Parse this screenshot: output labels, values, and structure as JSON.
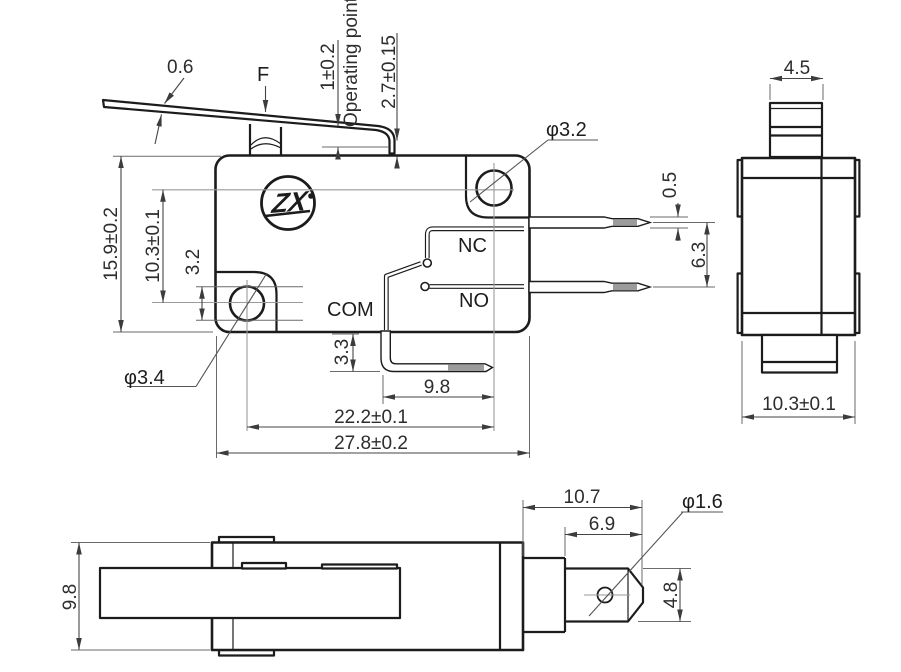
{
  "drawing": {
    "title": "Micro switch dimensional drawing",
    "logo_text": "ZX",
    "front": {
      "lever_thickness": "0.6",
      "force": "F",
      "pretravel": "1±0.2",
      "operating_point": "Operating point",
      "operating_height": "2.7±0.15",
      "top_hole_dia": "φ3.2",
      "body_height": "15.9±0.2",
      "hole_pitch_vertical": "10.3±0.1",
      "hole_edge_offset": "3.2",
      "bottom_hole_dia": "φ3.4",
      "com": "COM",
      "nc": "NC",
      "no": "NO",
      "terminal_thickness": "0.5",
      "terminal_pitch": "6.3",
      "com_terminal_drop": "3.3",
      "com_terminal_length": "9.8",
      "hole_pitch_horizontal": "22.2±0.1",
      "body_length": "27.8±0.2"
    },
    "side": {
      "plunger_width": "4.5",
      "body_width": "10.3±0.1"
    },
    "bottom": {
      "body_depth": "9.8",
      "terminal_length": "10.7",
      "terminal_flat_length": "6.9",
      "terminal_hole_dia": "φ1.6",
      "terminal_width": "4.8"
    }
  }
}
